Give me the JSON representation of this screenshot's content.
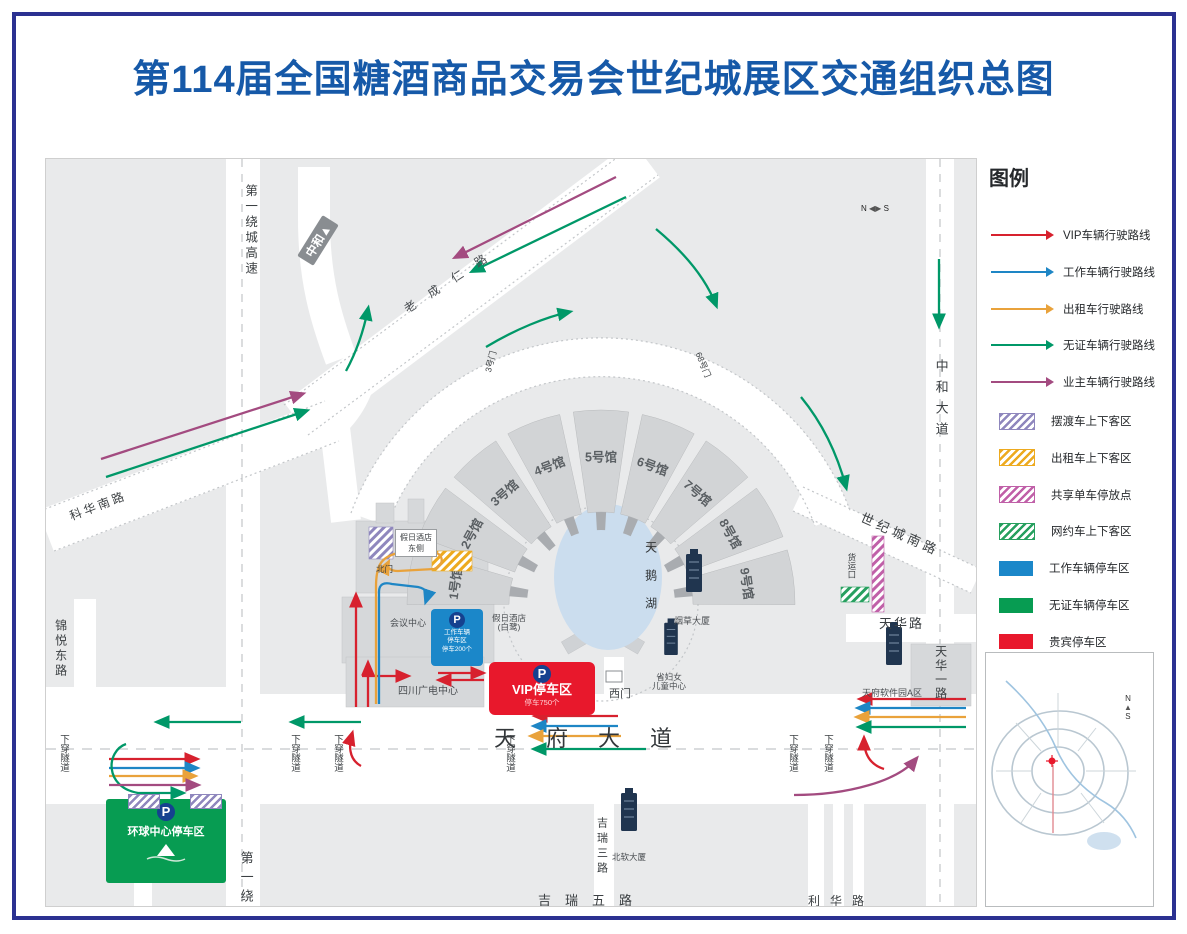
{
  "title": "第114届全国糖酒商品交易会世纪城展区交通组织总图",
  "colors": {
    "title_blue": "#1659A8",
    "border_navy": "#2B3191",
    "vip_route_red": "#D7212E",
    "work_route_blue": "#1E86C5",
    "taxi_route_orange": "#E9A23B",
    "nopermit_route_green": "#009868",
    "owner_route_purple": "#A34B80",
    "shuttle_zone_hatch": "#8F87BD",
    "taxi_zone_hatch": "#EDAA1F",
    "bike_zone_hatch": "#C060A8",
    "rideshare_zone_hatch": "#27A05F",
    "work_parking_blue": "#1B87C9",
    "nopermit_parking_green": "#079C52",
    "vip_parking_red": "#E8182C",
    "p_icon_blue": "#15418F"
  },
  "legend": {
    "title": "图例",
    "routes": [
      {
        "label": "VIP车辆行驶路线",
        "color_key": "vip_route_red"
      },
      {
        "label": "工作车辆行驶路线",
        "color_key": "work_route_blue"
      },
      {
        "label": "出租车行驶路线",
        "color_key": "taxi_route_orange"
      },
      {
        "label": "无证车辆行驶路线",
        "color_key": "nopermit_route_green"
      },
      {
        "label": "业主车辆行驶路线",
        "color_key": "owner_route_purple"
      }
    ],
    "zones": [
      {
        "label": "摆渡车上下客区",
        "style": "hatch",
        "color_key": "shuttle_zone_hatch"
      },
      {
        "label": "出租车上下客区",
        "style": "hatch",
        "color_key": "taxi_zone_hatch"
      },
      {
        "label": "共享单车停放点",
        "style": "hatch",
        "color_key": "bike_zone_hatch"
      },
      {
        "label": "网约车上下客区",
        "style": "hatch",
        "color_key": "rideshare_zone_hatch"
      },
      {
        "label": "工作车辆停车区",
        "style": "solid",
        "color_key": "work_parking_blue"
      },
      {
        "label": "无证车辆停车区",
        "style": "solid",
        "color_key": "nopermit_parking_green"
      },
      {
        "label": "贵宾停车区",
        "style": "solid",
        "color_key": "vip_parking_red"
      }
    ]
  },
  "map": {
    "roads": {
      "first_ring_expy": "第一绕城高速",
      "first_ring_partial": "第一绕",
      "zhonghe_ave": "中和大道",
      "century_south": "世纪城南路",
      "tianhua_rd": "天华路",
      "tianhua_first": "天华一路",
      "tianfu_ave": "天府大道",
      "kehua_south": "科华南路",
      "jinyue_east": "锦悦东路",
      "jirui_third": "吉瑞三路",
      "jirui_fifth": "吉瑞五路",
      "lihua_rd": "利华路",
      "chengren_rd": "老成仁路",
      "tunnel": "下穿隧道"
    },
    "signs": {
      "zhonghe": "中和",
      "arrow_up": "▲",
      "compass_n": "N",
      "compass_s": "S"
    },
    "gates": {
      "gate3": "3号门",
      "gate68": "68号门",
      "west": "西门",
      "north": "北门",
      "freight": "货运口"
    },
    "halls": [
      "1号馆",
      "2号馆",
      "3号馆",
      "4号馆",
      "5号馆",
      "6号馆",
      "7号馆",
      "8号馆",
      "9号馆"
    ],
    "lake": "天鹅湖",
    "buildings": {
      "conference": "会议中心",
      "sunken_plaza": "下沉式广场",
      "holiday_inn_l1": "假日酒店",
      "holiday_inn_l2": "(白鹭)",
      "shuttle_stop_l1": "假日酒店",
      "shuttle_stop_l2": "东侧",
      "scrtv": "四川广电中心",
      "tobacco": "烟草大厦",
      "women_children_l1": "省妇女",
      "women_children_l2": "儿童中心",
      "software_park": "天府软件园A区",
      "beiruan": "北软大厦"
    },
    "parking": {
      "p": "P",
      "vip_title": "VIP停车区",
      "vip_sub": "停车750个",
      "work_l1": "工作车辆",
      "work_l2": "停车区",
      "work_l3": "停车200个",
      "global_center": "环球中心停车区"
    }
  }
}
